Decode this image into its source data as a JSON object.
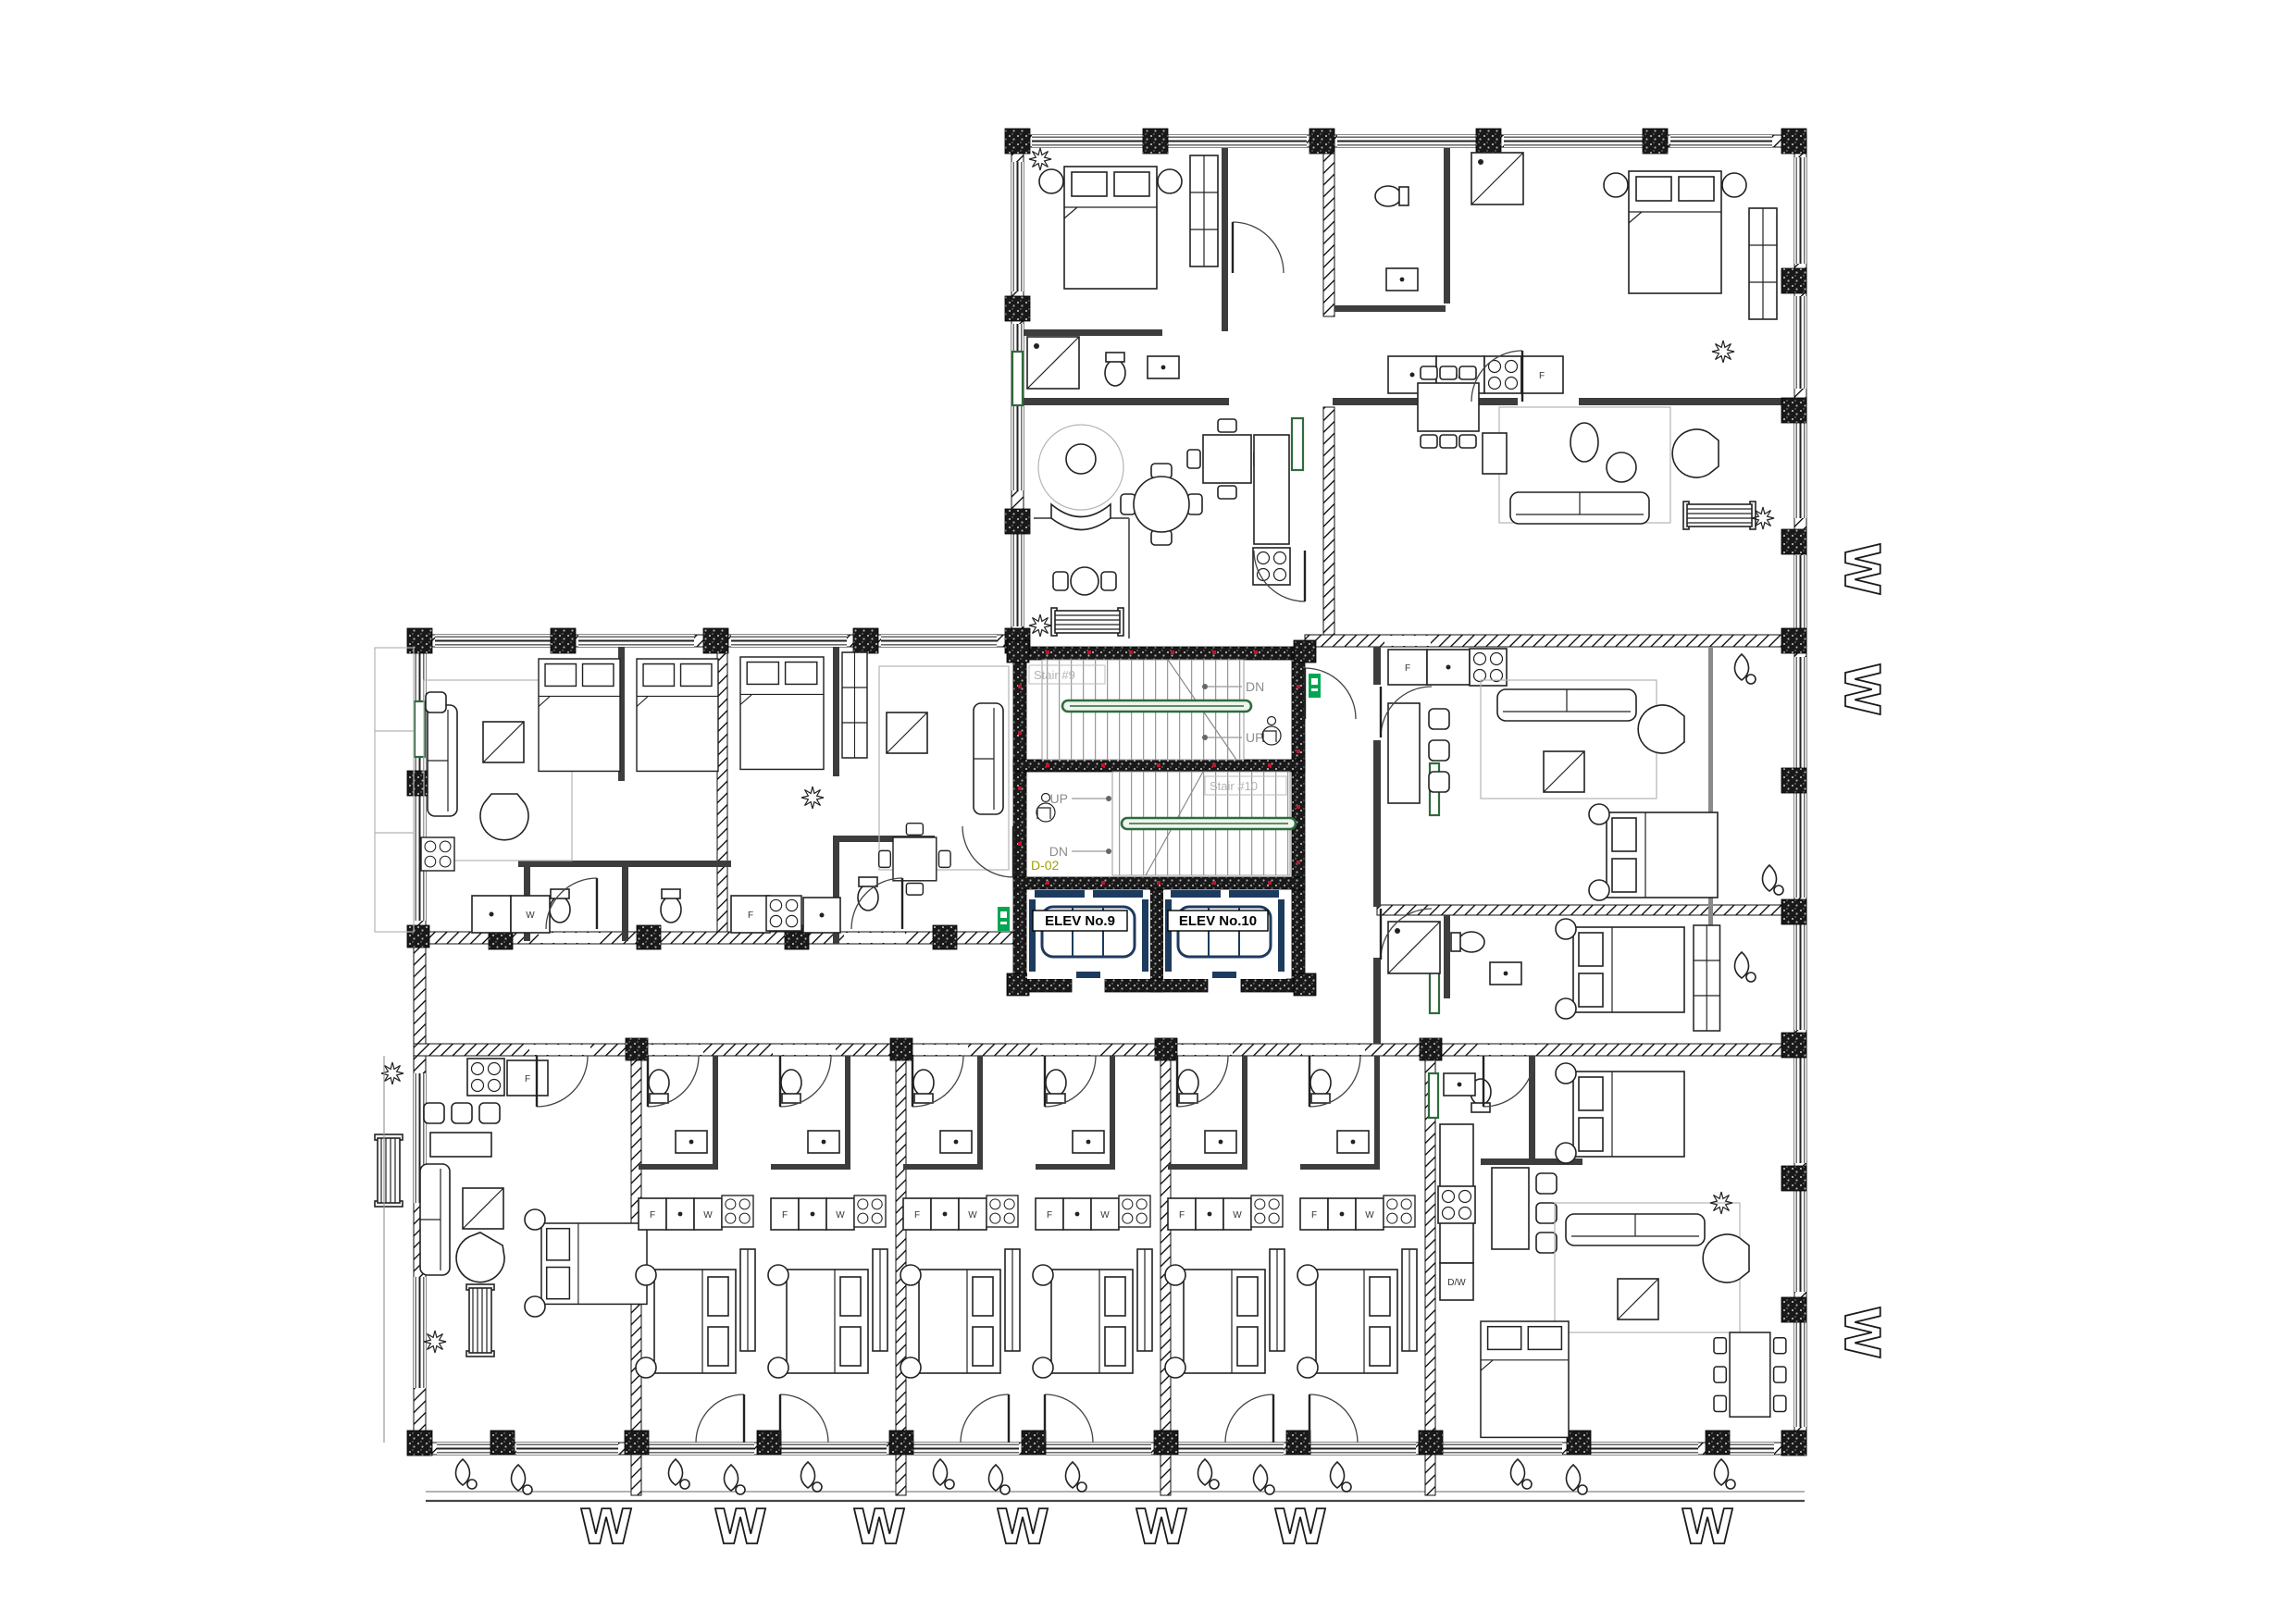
{
  "plan": {
    "core": {
      "stairs": [
        {
          "id": "stair-9",
          "name": "Stair #9",
          "dir_top": "DN",
          "dir_bottom": "UP"
        },
        {
          "id": "stair-10",
          "name": "Stair #10",
          "dir_top": "UP",
          "dir_bottom": "DN"
        }
      ],
      "elevators": [
        {
          "label": "ELEV No.9"
        },
        {
          "label": "ELEV No.10"
        }
      ],
      "door_tag": "D-02"
    },
    "appliances": {
      "fridge": "F",
      "washer": "W",
      "dishwasher": "D/W"
    },
    "window_tag": "W",
    "colors": {
      "exit_green": "#00A651",
      "rail_green": "#2F6B3C",
      "elevator_blue": "#1D3B5E",
      "door_tag_olive": "#A3A000",
      "stair_text_gray": "#B3B3B3",
      "direction_gray": "#8C8C8C",
      "wall_black": "#111111",
      "fire_dot_red": "#C41230"
    }
  }
}
